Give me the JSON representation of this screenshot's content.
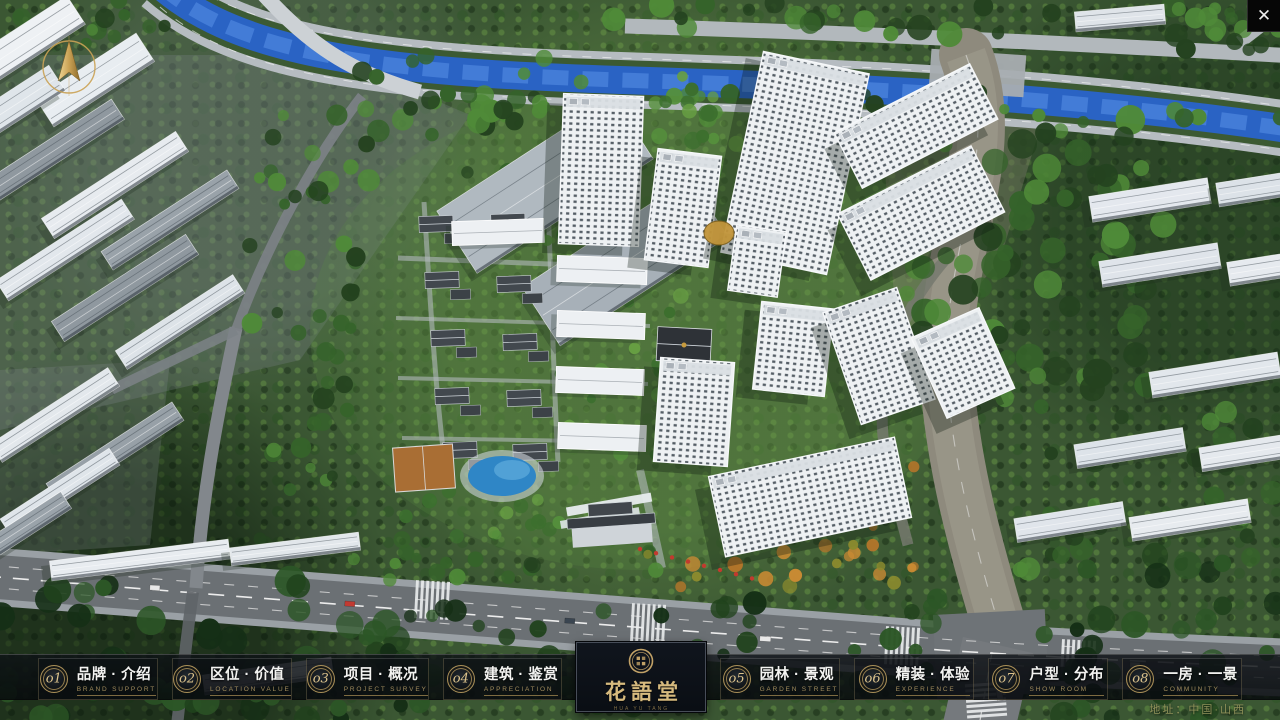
{
  "window": {
    "close_icon": "✕"
  },
  "overlay": {
    "address": "地址：中国·山西"
  },
  "logo": {
    "name": "花語堂",
    "caption": "HUA YU TANG"
  },
  "nav": {
    "items": [
      {
        "num": "o1",
        "label": "品牌 · 介绍",
        "sub": "BRAND SUPPORT"
      },
      {
        "num": "o2",
        "label": "区位 · 价值",
        "sub": "LOCATION VALUE"
      },
      {
        "num": "o3",
        "label": "项目 · 概况",
        "sub": "PROJECT SURVEY"
      },
      {
        "num": "o4",
        "label": "建筑 · 鉴赏",
        "sub": "APPRECIATION"
      },
      {
        "num": "o5",
        "label": "园林 · 景观",
        "sub": "GARDEN STREET"
      },
      {
        "num": "o6",
        "label": "精装 · 体验",
        "sub": "EXPERIENCE"
      },
      {
        "num": "o7",
        "label": "户型 · 分布",
        "sub": "SHOW ROOM"
      },
      {
        "num": "o8",
        "label": "一房 · 一景",
        "sub": "COMMUNITY"
      }
    ]
  },
  "ui_colors": {
    "gold": "#c8a868",
    "gold_dark": "#8f7a4c",
    "bar_background": "rgba(10,14,18,0.8)",
    "panel_background": "#0b0f15",
    "water_blue": "#2a63c4"
  }
}
